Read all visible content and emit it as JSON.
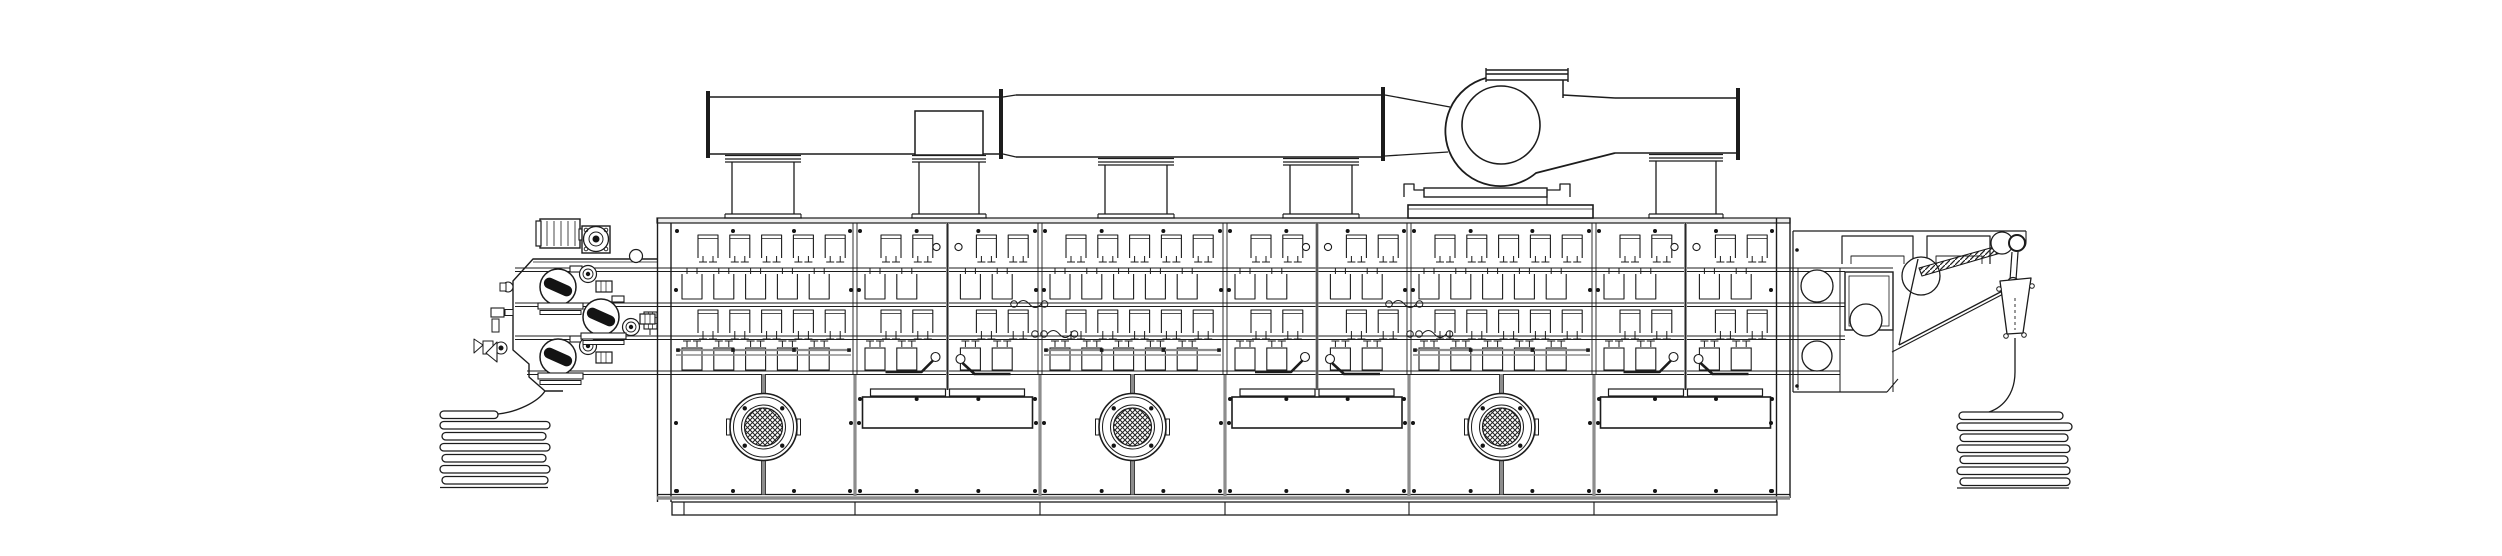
{
  "meta": {
    "drawing_type": "engineering-line-drawing",
    "subject": "continuous fabric dryer line - side elevation",
    "visible_text": "none"
  },
  "colors": {
    "background": "#ffffff",
    "line": "#1c1c1c",
    "gray_structure": "#8d8d8d",
    "light_gray": "#ececec",
    "dark_fill": "#141414"
  },
  "components": [
    {
      "name": "fabric-feed-stack",
      "folds": 7
    },
    {
      "name": "entry-padder-unit",
      "rollers": 3,
      "gear-motors": 4
    },
    {
      "name": "drying-chamber",
      "count": 6,
      "nozzle_rows": 4
    },
    {
      "name": "chamber-door",
      "count": 3,
      "knobs_per_door": 2
    },
    {
      "name": "circulation-fan",
      "count": 3
    },
    {
      "name": "access-panel",
      "count": 3
    },
    {
      "name": "exhaust-duct",
      "risers": 5
    },
    {
      "name": "centrifugal-exhaust-fan",
      "count": 1
    },
    {
      "name": "exit-plaiter-unit",
      "rollers": 4,
      "pulleys": 2
    },
    {
      "name": "fabric-exit-stack",
      "folds": 7
    }
  ],
  "machine": {
    "body": {
      "left": 657,
      "left2": 671,
      "right": 1777,
      "right2": 1790,
      "top": 218,
      "roof_bottom": 223,
      "panel_top": 374,
      "black_base": 494.5,
      "gray_base": 498,
      "skirt": {
        "x": 672,
        "y": 502,
        "w": 1105,
        "h": 13
      }
    },
    "walls": [
      855,
      1040,
      1225,
      1409,
      1594
    ],
    "bounds": [
      672,
      855,
      1040,
      1225,
      1409,
      1594,
      1777
    ],
    "types": [
      "fan",
      "panel",
      "fan",
      "panel",
      "fan",
      "panel"
    ],
    "rails": [
      [
        268,
        271.5
      ],
      [
        303,
        306.5
      ],
      [
        336,
        339.5
      ]
    ],
    "rail_x": [
      515,
      1845
    ],
    "rail4": {
      "y": [
        371,
        374.5
      ],
      "x": [
        527,
        1840
      ]
    },
    "grid": {
      "offA": 26,
      "offB": 10,
      "pitch": 31.8,
      "bw": 20
    },
    "rows": {
      "r1top": 235,
      "r1bot": 258,
      "r1feet": 262,
      "r2hat": 268,
      "r2top": 274,
      "r2bot": 299,
      "r3top": 310,
      "r3bot": 333,
      "r3feet": 339,
      "r4hat": 341,
      "r4top": 348,
      "r4h": 22
    },
    "door": {
      "y1": 223,
      "y2": 390,
      "knob_y": 247,
      "knob_dx": 11,
      "knob_r": 3.6
    },
    "fan": {
      "cy": 427,
      "r_outer": 33.5,
      "r_ring": 30,
      "r_ring2": 22,
      "r_mesh": 19,
      "bolt_r": 26.5
    },
    "panel": {
      "strip_y": 389,
      "strip_h": 7,
      "strip_w": 75,
      "strip_gap": 2,
      "rect_y": 397,
      "rect_h": 31,
      "rect_half": 85
    },
    "gray_rail_y": [
      350,
      355
    ],
    "squiggles": [
      {
        "x": 1014,
        "y": 304,
        "extra": false
      },
      {
        "x": 1389,
        "y": 304,
        "extra": false
      },
      {
        "x": 1044,
        "y": 334,
        "extra": true
      },
      {
        "x": 1419,
        "y": 334,
        "extra": true
      }
    ]
  },
  "exhaust": {
    "risers": [
      {
        "x": 731,
        "w": 64,
        "top": 154
      },
      {
        "x": 918,
        "w": 62,
        "top": 154,
        "box": [
          915,
          111,
          68,
          44
        ]
      },
      {
        "x": 1104,
        "w": 64,
        "top": 157
      },
      {
        "x": 1289,
        "w": 64,
        "top": 157
      },
      {
        "x": 1655,
        "w": 62,
        "top": 153
      }
    ],
    "duct_ops": [
      [
        "l",
        709,
        97,
        1002,
        97,
        1.5
      ],
      [
        "l",
        709,
        154,
        1002,
        154,
        1.5
      ],
      [
        "b",
        706,
        91,
        4,
        67
      ],
      [
        "b",
        999,
        89,
        4,
        70
      ],
      [
        "l",
        1003,
        97,
        1016,
        95,
        1.3
      ],
      [
        "l",
        1016,
        95,
        1381,
        95,
        1.5
      ],
      [
        "l",
        1003,
        154,
        1016,
        157,
        1.3
      ],
      [
        "l",
        1016,
        157,
        1381,
        157,
        1.5
      ],
      [
        "b",
        1381,
        87,
        4,
        74
      ],
      [
        "l",
        1385,
        95,
        1450,
        107,
        1.3
      ],
      [
        "l",
        1385,
        156,
        1448,
        152,
        1.3
      ],
      [
        "l",
        1615,
        98,
        1738,
        98,
        1.5
      ],
      [
        "l",
        1615,
        153,
        1738,
        153,
        1.5
      ],
      [
        "b",
        1736,
        88,
        4,
        72
      ]
    ],
    "fan_ops": [
      [
        "p",
        "M1486,78 A55,55 0 1 0 1536,173 L1615,153",
        1.8,
        "none"
      ],
      [
        "l",
        1563,
        80,
        1563,
        98,
        1.5
      ],
      [
        "l",
        1563,
        95,
        1615,
        98,
        1.5
      ],
      [
        "c",
        1501,
        125,
        39,
        1.6,
        "#fff"
      ],
      [
        "l",
        1486,
        70,
        1568,
        70,
        1.4
      ],
      [
        "l",
        1486,
        74,
        1568,
        74,
        1.4
      ],
      [
        "l",
        1486,
        80,
        1568,
        80,
        1.4
      ],
      [
        "l",
        1486,
        68,
        1486,
        82,
        1.4
      ],
      [
        "l",
        1568,
        68,
        1568,
        82,
        1.4
      ],
      [
        "p",
        "M1404,197 V184 H1414 V190 H1428",
        1.3,
        "none"
      ],
      [
        "p",
        "M1570,197 V184 H1560 V190 H1547",
        1.3,
        "none"
      ],
      [
        "r",
        1424,
        188,
        123,
        9,
        1.4,
        "#fff"
      ],
      [
        "l",
        1547,
        197,
        1547,
        205,
        1.1
      ],
      [
        "r",
        1408,
        205,
        185,
        13,
        1.6,
        "#fff"
      ],
      [
        "l",
        1408,
        209,
        1593,
        209,
        0.8
      ]
    ]
  },
  "entry_ops": [
    [
      "p",
      "M657,259 H533 L513,281 V350 L529,364 V377 L545,391 H563",
      1.4,
      "none"
    ],
    [
      "l",
      533,
      262,
      657,
      262,
      0.8
    ],
    [
      "r",
      540,
      219,
      40,
      29,
      1.4,
      "#fff"
    ],
    [
      "l",
      547,
      221,
      547,
      246,
      0.8
    ],
    [
      "l",
      554,
      221,
      554,
      246,
      0.8
    ],
    [
      "l",
      561,
      221,
      561,
      246,
      0.8
    ],
    [
      "l",
      568,
      221,
      568,
      246,
      0.8
    ],
    [
      "l",
      575,
      221,
      575,
      246,
      0.8
    ],
    [
      "r",
      536,
      221,
      5,
      25,
      1.2,
      "#fff"
    ],
    [
      "r",
      579,
      229,
      5,
      11,
      1.1,
      "#fff"
    ],
    [
      "r",
      582,
      226,
      28,
      27,
      1.4,
      "#fff"
    ],
    [
      "c",
      596,
      239,
      12.5,
      1.3,
      "#fff"
    ],
    [
      "c",
      596,
      239,
      7,
      1,
      "none"
    ],
    [
      "c",
      596,
      239,
      3.5,
      0,
      "#141414"
    ],
    [
      "c",
      586,
      230,
      1.8,
      0.9,
      "none"
    ],
    [
      "c",
      606,
      230,
      1.8,
      0.9,
      "none"
    ],
    [
      "c",
      586,
      249,
      1.8,
      0.9,
      "none"
    ],
    [
      "c",
      606,
      249,
      1.8,
      0.9,
      "none"
    ],
    [
      "c",
      636,
      256,
      6.5,
      1.2,
      "#fff"
    ],
    [
      "r",
      644,
      312,
      13,
      17,
      1.1,
      "#fff"
    ],
    [
      "l",
      648.3,
      312,
      648.3,
      329,
      0.7
    ],
    [
      "l",
      652.6,
      312,
      652.6,
      329,
      0.7
    ],
    [
      "l",
      644,
      317.7,
      657,
      317.7,
      0.7
    ],
    [
      "l",
      644,
      323.4,
      657,
      323.4,
      0.7
    ],
    [
      "l",
      650,
      329,
      650,
      335,
      1
    ],
    [
      "r",
      570,
      266,
      12,
      6,
      1.1,
      "#fff"
    ],
    [
      "r",
      612,
      296,
      12,
      6,
      1.1,
      "#fff"
    ],
    [
      "r",
      570,
      336,
      12,
      6,
      1.1,
      "#fff"
    ],
    [
      "c",
      558,
      287,
      18,
      1.5,
      "#fff"
    ],
    [
      "band",
      558,
      287,
      30,
      11,
      24
    ],
    [
      "c",
      601,
      317,
      18,
      1.5,
      "#fff"
    ],
    [
      "band",
      601,
      317,
      30,
      11,
      24
    ],
    [
      "c",
      558,
      357,
      18,
      1.5,
      "#fff"
    ],
    [
      "band",
      558,
      357,
      30,
      11,
      24
    ],
    [
      "c",
      588,
      274,
      8.5,
      1.2,
      "#fff"
    ],
    [
      "c",
      588,
      274,
      5,
      0.9,
      "none"
    ],
    [
      "c",
      588,
      274,
      2.2,
      0,
      "#141414"
    ],
    [
      "c",
      631,
      327,
      8.5,
      1.2,
      "#fff"
    ],
    [
      "c",
      631,
      327,
      5,
      0.9,
      "none"
    ],
    [
      "c",
      631,
      327,
      2.2,
      0,
      "#141414"
    ],
    [
      "c",
      588,
      346,
      8.5,
      1.2,
      "#fff"
    ],
    [
      "c",
      588,
      346,
      5,
      0.9,
      "none"
    ],
    [
      "c",
      588,
      346,
      2.2,
      0,
      "#141414"
    ],
    [
      "r",
      596,
      281,
      16,
      11,
      1.2,
      "#fff"
    ],
    [
      "l",
      601,
      281,
      601,
      292,
      0.7
    ],
    [
      "l",
      606,
      281,
      606,
      292,
      0.7
    ],
    [
      "r",
      640,
      314,
      15,
      10,
      1.2,
      "#fff"
    ],
    [
      "l",
      645,
      314,
      645,
      324,
      0.7
    ],
    [
      "l",
      650,
      314,
      650,
      324,
      0.7
    ],
    [
      "r",
      596,
      352,
      16,
      11,
      1.2,
      "#fff"
    ],
    [
      "l",
      601,
      352,
      601,
      363,
      0.7
    ],
    [
      "l",
      606,
      352,
      606,
      363,
      0.7
    ],
    [
      "r",
      538,
      303,
      45,
      6,
      1.1,
      "#fff"
    ],
    [
      "r",
      540,
      310.5,
      41,
      4,
      1,
      "#fff"
    ],
    [
      "r",
      581,
      333,
      45,
      6,
      1.1,
      "#fff"
    ],
    [
      "r",
      583,
      340.5,
      41,
      4,
      1,
      "#fff"
    ],
    [
      "r",
      538,
      373,
      45,
      6,
      1.1,
      "#fff"
    ],
    [
      "r",
      540,
      380.5,
      41,
      4,
      1,
      "#fff"
    ],
    [
      "c",
      508,
      287,
      5,
      1.1,
      "#fff"
    ],
    [
      "r",
      500,
      283,
      6,
      8,
      1,
      "#fff"
    ],
    [
      "r",
      491,
      308,
      13,
      9,
      1.1,
      "#fff"
    ],
    [
      "r",
      505,
      309.5,
      8,
      6,
      1,
      "#fff"
    ],
    [
      "r",
      492,
      319,
      7,
      13,
      1,
      "#fff"
    ],
    [
      "c",
      501,
      348,
      6,
      1.1,
      "#fff"
    ],
    [
      "c",
      501,
      348,
      2.5,
      0,
      "#141414"
    ],
    [
      "r",
      483,
      341,
      10,
      13,
      1,
      "#fff"
    ],
    [
      "p",
      "M483,345 L474,339 V353 Z",
      1,
      "#fff"
    ],
    [
      "p",
      "M497,342 L486,353 L497,362 Z",
      1.1,
      "#fff"
    ],
    [
      "p",
      "M545,391 C538,402 517,412 498,414",
      1.3,
      "none"
    ]
  ],
  "exit_ops": [
    [
      "l",
      1793,
      231,
      2026,
      231,
      1.2
    ],
    [
      "p",
      "M2026,231 V242 q0,6 -6,8",
      1.1,
      "none"
    ],
    [
      "l",
      1793,
      231,
      1793,
      392,
      1.2
    ],
    [
      "l",
      1798,
      268,
      1798,
      390,
      0.9
    ],
    [
      "l",
      1793,
      268,
      1893,
      268,
      1
    ],
    [
      "l",
      1840,
      268,
      1840,
      392,
      1
    ],
    [
      "l",
      1893,
      273,
      1893,
      392,
      1
    ],
    [
      "l",
      1793,
      392,
      1887,
      392,
      1.2
    ],
    [
      "p",
      "M1887,392 L1898,379",
      1.1,
      "none"
    ],
    [
      "p",
      "M1842,264 V236 H1913 V264",
      1.2,
      "none"
    ],
    [
      "p",
      "M1851,264 V256 H1904 V264",
      0.9,
      "none"
    ],
    [
      "p",
      "M1927,264 V236 H1990 V264",
      1.2,
      "none"
    ],
    [
      "p",
      "M1936,264 V256 H1982 V264",
      0.9,
      "none"
    ],
    [
      "c",
      1817,
      286,
      16,
      1.3,
      "#fff"
    ],
    [
      "c",
      1817,
      356,
      15,
      1.3,
      "#fff"
    ],
    [
      "r",
      1845,
      272,
      48,
      58,
      1.4,
      "#fff"
    ],
    [
      "r",
      1849,
      276,
      40,
      50,
      0.8,
      "none"
    ],
    [
      "c",
      1866,
      320,
      16,
      1.3,
      "#fff"
    ],
    [
      "c",
      1921,
      276,
      19,
      1.3,
      "#fff"
    ],
    [
      "l",
      1918,
      259,
      1899,
      345,
      1.3
    ],
    [
      "l",
      1899,
      345,
      2012,
      286,
      1.3
    ],
    [
      "l",
      1892,
      352,
      2009,
      291,
      1.1
    ],
    [
      "p",
      "M1919,268 L2001,245 L2004,252 L1922,276 Z",
      1.1,
      "url(#hatch)"
    ],
    [
      "c",
      2002,
      243,
      11,
      1.2,
      "#fff"
    ],
    [
      "c",
      2017,
      243,
      8,
      2,
      "#fff"
    ],
    [
      "l",
      2012,
      252,
      2010,
      280,
      1.2
    ],
    [
      "l",
      2018,
      252,
      2016,
      280,
      1.2
    ],
    [
      "c",
      2013,
      283,
      5.5,
      1.2,
      "#fff"
    ],
    [
      "c",
      2013,
      283,
      2.2,
      0,
      "#141414"
    ],
    [
      "p",
      "M2000,281 L2031,278 L2023,333 L2007,334 Z",
      1.3,
      "#fff"
    ],
    [
      "c",
      1999,
      289,
      2.3,
      1,
      "#fff"
    ],
    [
      "c",
      2032,
      286,
      2.3,
      1,
      "#fff"
    ],
    [
      "c",
      2006,
      336,
      2.3,
      1,
      "#fff"
    ],
    [
      "c",
      2024,
      335,
      2.3,
      1,
      "#fff"
    ],
    [
      "dash",
      2015,
      298,
      2015,
      330
    ],
    [
      "p",
      "M2015,338 V372 C2015,393 2004,407 1989,412",
      1.3,
      "none"
    ],
    [
      "c",
      1797,
      250,
      1.8,
      0,
      "#141414"
    ],
    [
      "c",
      1797,
      386,
      1.8,
      0,
      "#141414"
    ]
  ],
  "stacks": {
    "loop_h": 7.5,
    "left": {
      "bottom": [
        440,
        487.5,
        548
      ],
      "curve": null,
      "loops": [
        [
          440,
          411,
          58
        ],
        [
          440,
          421.5,
          110
        ],
        [
          442,
          432.5,
          104
        ],
        [
          440,
          443.5,
          110
        ],
        [
          442,
          454.5,
          104
        ],
        [
          440,
          465.5,
          110
        ],
        [
          442,
          476.5,
          106
        ]
      ]
    },
    "right": {
      "bottom": [
        1957,
        488,
        2069
      ],
      "curve": null,
      "loops": [
        [
          1959,
          412,
          104
        ],
        [
          1957,
          423,
          115
        ],
        [
          1960,
          434,
          108
        ],
        [
          1957,
          445,
          113
        ],
        [
          1960,
          456,
          108
        ],
        [
          1957,
          467,
          113
        ],
        [
          1960,
          478,
          110
        ]
      ]
    }
  }
}
